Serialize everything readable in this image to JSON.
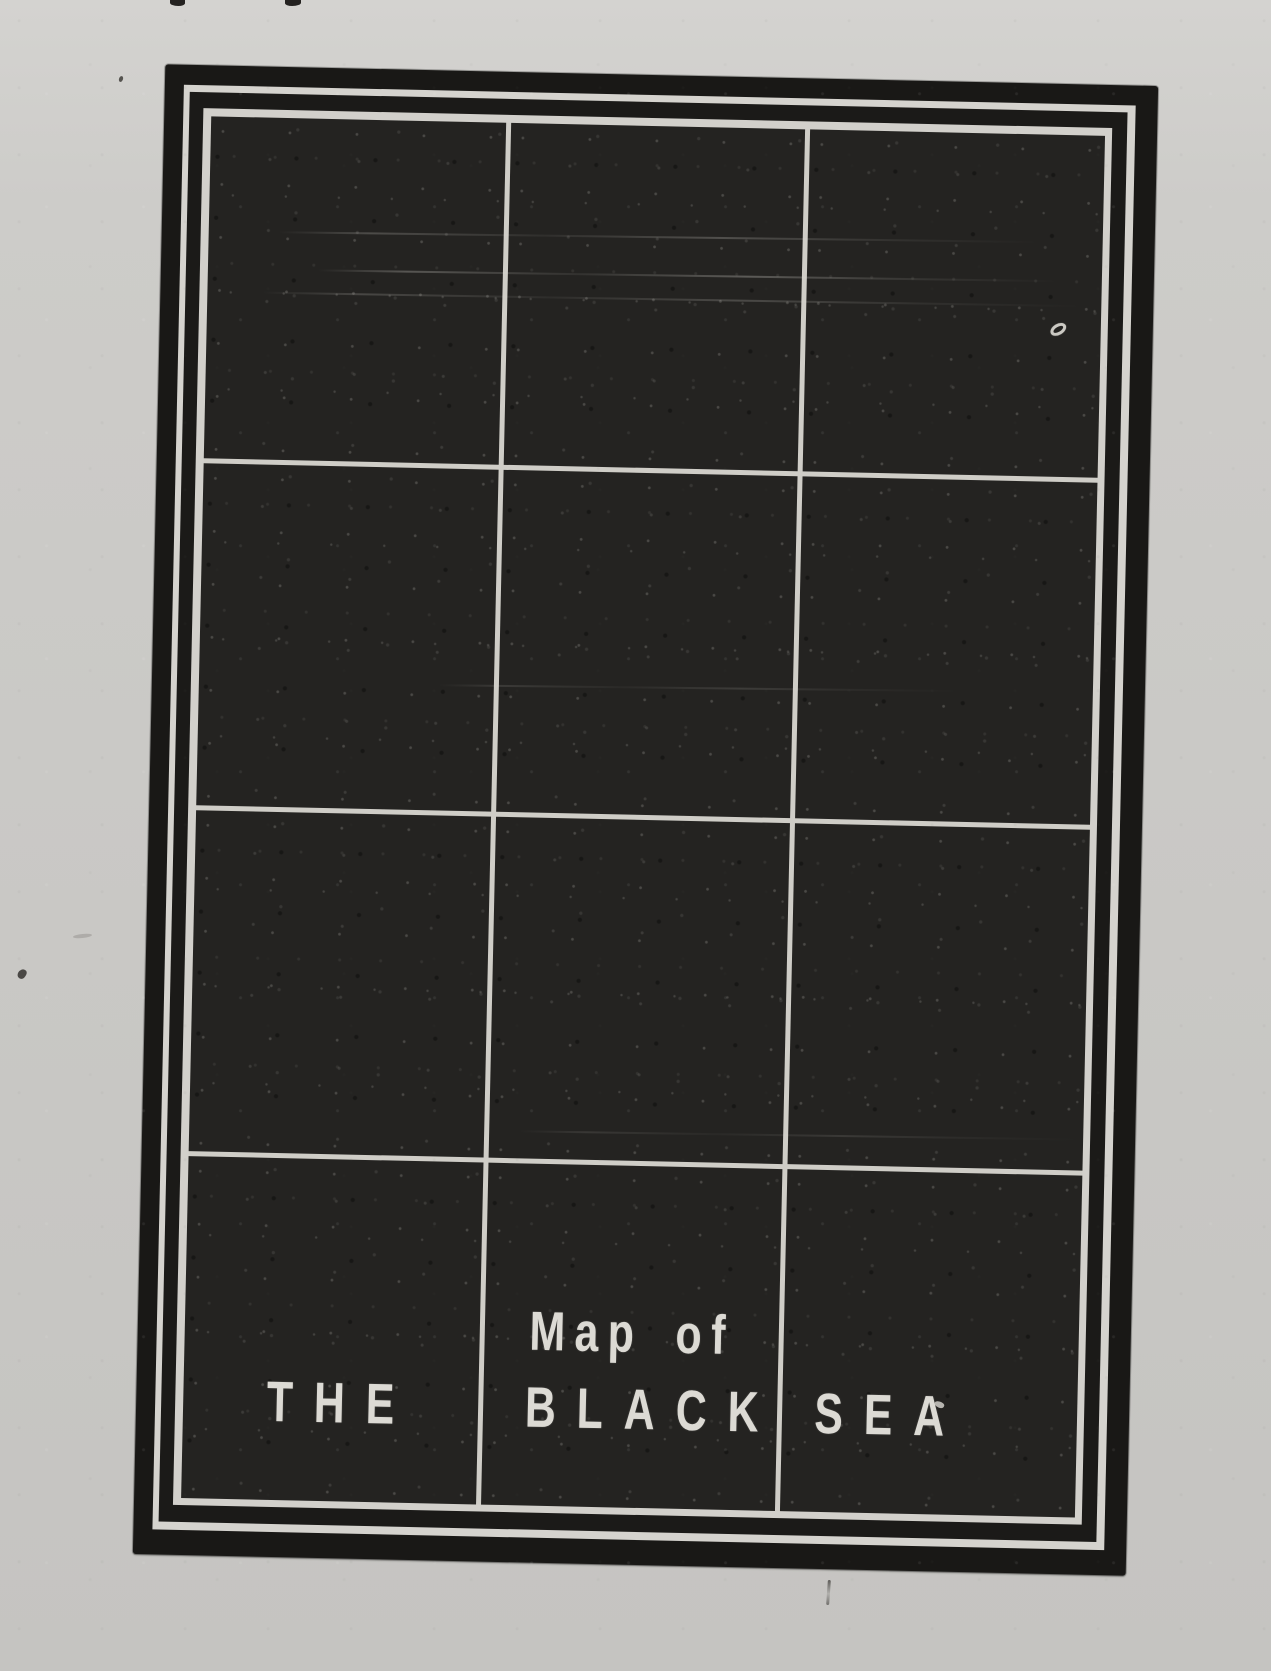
{
  "page": {
    "paper_color": "#cac9c6"
  },
  "map": {
    "caption": "Map of",
    "title_words": [
      "THE",
      "BLACK",
      "SEA"
    ],
    "full_caption_reading": "Map of THE BLACK SEA",
    "grid": {
      "columns": 3,
      "rows": 4
    },
    "colors": {
      "ink_black": "#191816",
      "sea_fill": "#242321",
      "line_white": "#d2d0cb",
      "text_white": "#dcdad4"
    }
  }
}
